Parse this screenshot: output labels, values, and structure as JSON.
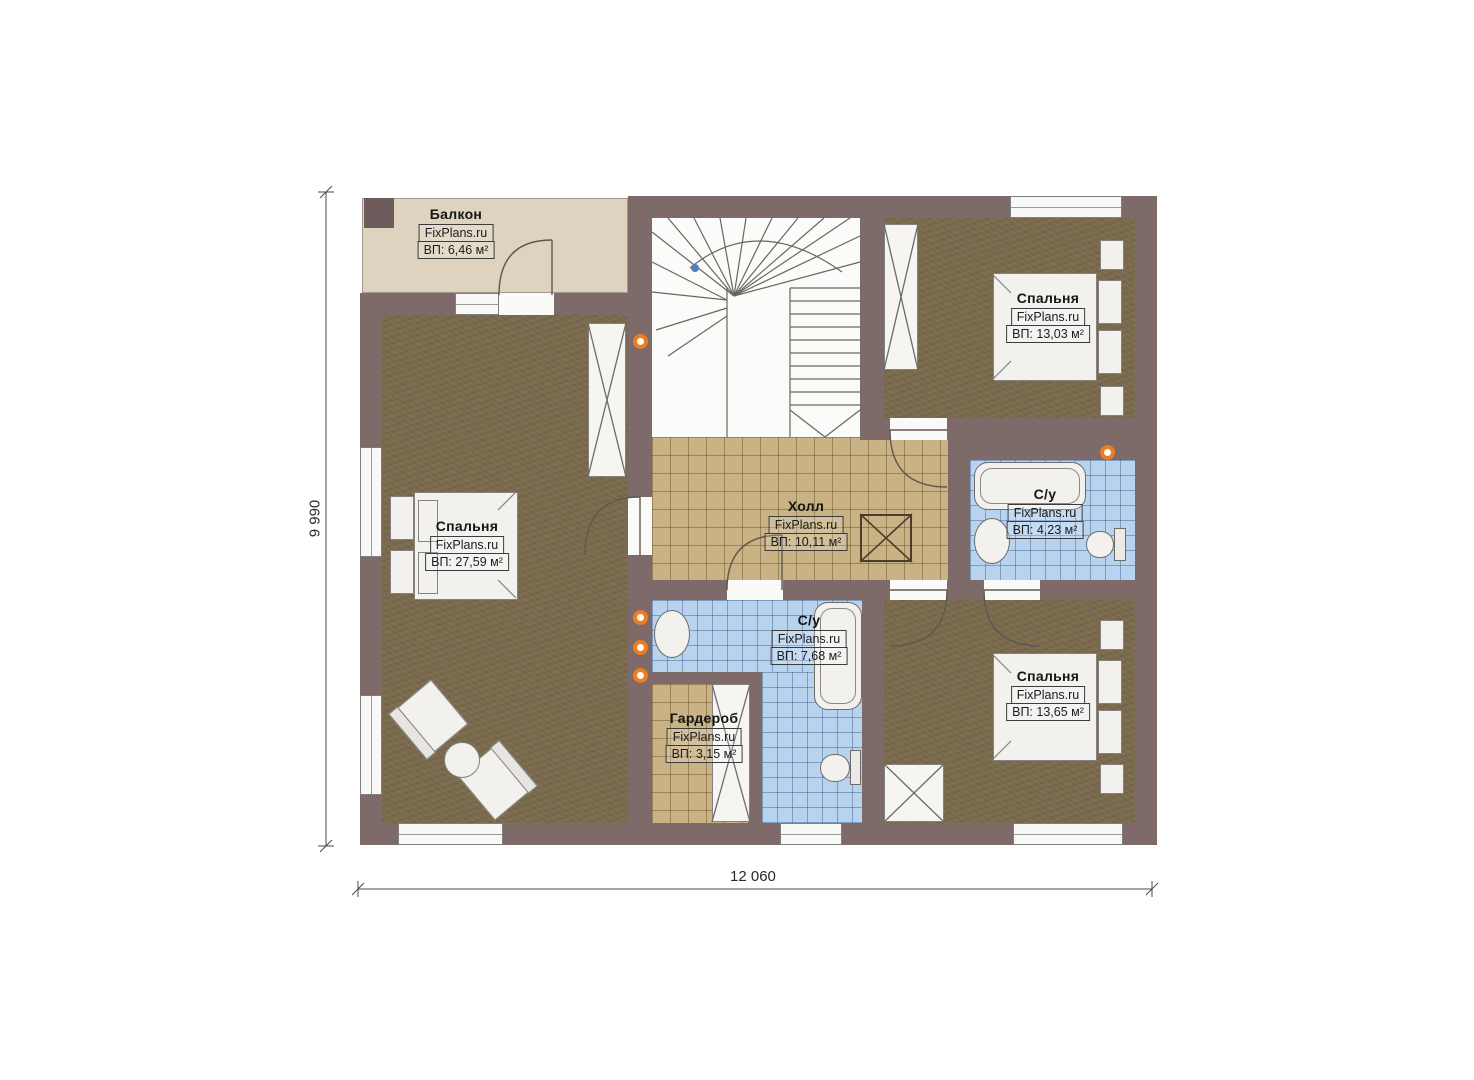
{
  "watermark": "FixPlans.ru",
  "rooms": {
    "balcony": {
      "name": "Балкон",
      "area": "ВП: 6,46 м²"
    },
    "bedroom_left": {
      "name": "Спальня",
      "area": "ВП: 27,59 м²"
    },
    "bedroom_top_right": {
      "name": "Спальня",
      "area": "ВП: 13,03 м²"
    },
    "bedroom_bottom_right": {
      "name": "Спальня",
      "area": "ВП: 13,65 м²"
    },
    "hall": {
      "name": "Холл",
      "area": "ВП: 10,11 м²"
    },
    "bathroom_right": {
      "name": "С/у",
      "area": "ВП: 4,23 м²"
    },
    "bathroom_center": {
      "name": "С/у",
      "area": "ВП: 7,68 м²"
    },
    "wardrobe": {
      "name": "Гардероб",
      "area": "ВП: 3,15 м²"
    }
  },
  "dimensions": {
    "bottom": "12 060",
    "left": "9 990"
  },
  "colors": {
    "wall": "#7d6a69",
    "wood_floor": "#7b6b4e",
    "hall_tile": "#c9b284",
    "bath_tile": "#b7d3ee",
    "balcony_floor": "#ddd3bf",
    "fixture_orange": "#ef7d1f",
    "stair_marker_blue": "#4f7fc2"
  }
}
